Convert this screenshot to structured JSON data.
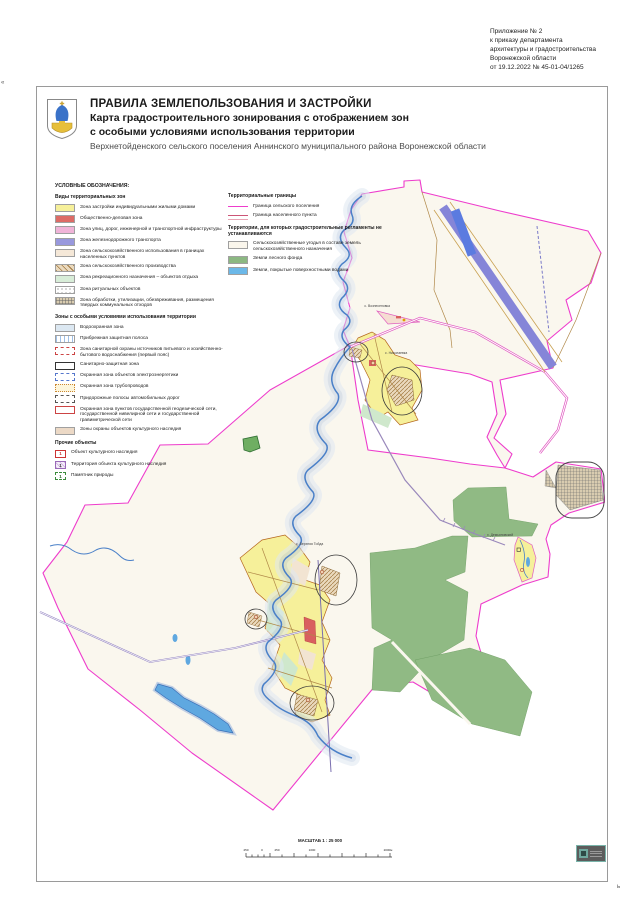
{
  "annotation": {
    "lines": [
      "Приложение № 2",
      "к приказу департамента",
      "архитектуры и градостроительства",
      "Воронежской области",
      "от 19.12.2022 № 45-01-04/1265"
    ]
  },
  "title_block": {
    "line1": "ПРАВИЛА ЗЕМЛЕПОЛЬЗОВАНИЯ И ЗАСТРОЙКИ",
    "line2": "Карта градостроительного зонирования с отображением зон",
    "line3": "с особыми условиями использования территории",
    "line4": "Верхнетойденского сельского поселения Аннинского муниципального района Воронежской области"
  },
  "legend": {
    "title": "УСЛОВНЫЕ ОБОЗНАЧЕНИЯ:",
    "sections": [
      {
        "heading": "Виды территориальных зон",
        "items": [
          {
            "label": "Зона застройки индивидуальными жилыми домами"
          },
          {
            "label": "Общественно-деловая зона"
          },
          {
            "label": "Зона улиц, дорог, инженерной и транспортной инфраструктуры"
          },
          {
            "label": "Зона железнодорожного транспорта"
          },
          {
            "label": "Зона сельскохозяйственного использования в границах населенных пунктов"
          },
          {
            "label": "Зона сельскохозяйственного производства"
          },
          {
            "label": "Зона рекреационного назначения – объектов отдыха"
          },
          {
            "label": "Зона ритуальных объектов"
          },
          {
            "label": "Зона обработки, утилизации, обезвреживания, размещения твердых коммунальных отходов"
          }
        ]
      },
      {
        "heading": "Зоны с особыми условиями использования территории",
        "items": [
          {
            "label": "Водоохранная зона"
          },
          {
            "label": "Прибрежная защитная полоса"
          },
          {
            "label": "Зона санитарной охраны источников питьевого и хозяйственно-бытового водоснабжения (первый пояс)"
          },
          {
            "label": "Санитарно-защитная зона"
          },
          {
            "label": "Охранная зона объектов электроэнергетики"
          },
          {
            "label": "Охранная зона трубопроводов"
          },
          {
            "label": "Придорожные полосы автомобильных дорог"
          },
          {
            "label": "Охранная зона пунктов государственной геодезической сети, государственной нивелирной сети и государственной гравиметрической сети"
          },
          {
            "label": "Зоны охраны объектов культурного наследия"
          }
        ]
      },
      {
        "heading": "Прочие объекты",
        "items": [
          {
            "label": "Объект культурного наследия",
            "marker": "1"
          },
          {
            "label": "Территория объекта культурного наследия",
            "marker": "1"
          },
          {
            "label": "Памятник природы",
            "marker": "1"
          }
        ]
      }
    ],
    "right_sections": [
      {
        "heading": "Территориальные границы",
        "items": [
          {
            "label": "Граница сельского поселения"
          },
          {
            "label": "Граница населенного пункта"
          }
        ]
      },
      {
        "heading": "Территории, для которых градостроительные регламенты не устанавливаются",
        "items": [
          {
            "label": "Сельскохозяйственные угодья в составе земель сельскохозяйственного назначения"
          },
          {
            "label": "Земли лесного фонда"
          },
          {
            "label": "Земли, покрытые поверхностными водами"
          }
        ]
      }
    ]
  },
  "map": {
    "labels": [
      {
        "text": "с. Вознесеновка"
      },
      {
        "text": "с. Николаевка"
      },
      {
        "text": "с. Верхняя Тойда"
      },
      {
        "text": "х. Демьяновский"
      }
    ],
    "scale": {
      "title": "МАСШТАБ 1 : 25 000",
      "ticks": [
        "250",
        "0",
        "250",
        "1000",
        "2000м"
      ]
    }
  },
  "edge_marks": {
    "left": "«",
    "bottom_right": "ь"
  },
  "colors": {
    "settlement_boundary": "#ee3ccc",
    "residential": "#f6f09a",
    "public_business": "#dd6b66",
    "railway": "#8585d8",
    "agri_land": "#faf7ee",
    "forest": "#90ba84",
    "water": "#5fa8e0",
    "water_buffer": "#c2d0e4"
  }
}
